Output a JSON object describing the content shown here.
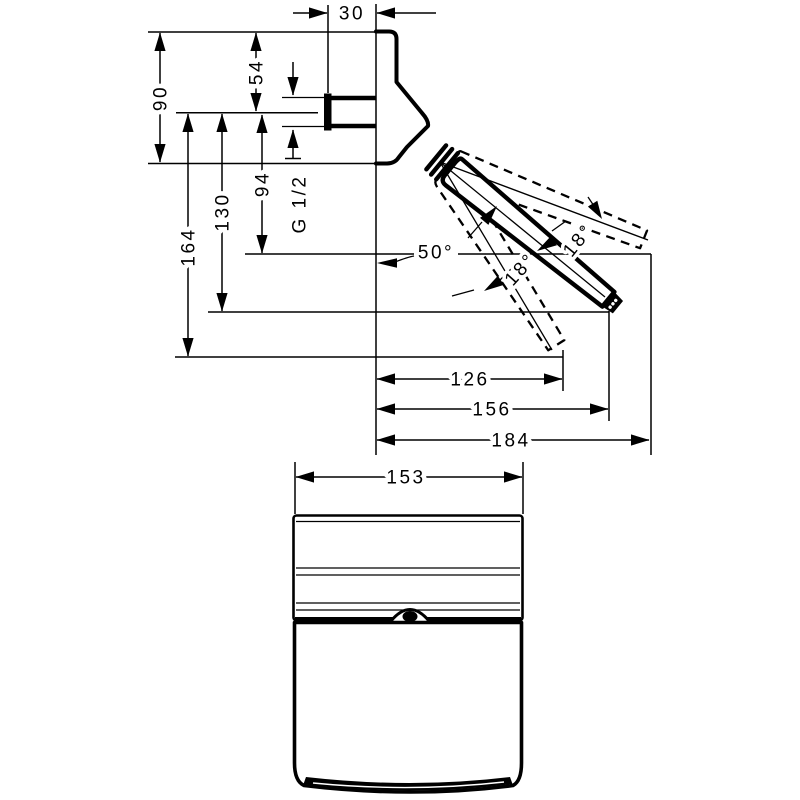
{
  "drawing": {
    "type": "technical-dimension-drawing",
    "units": "mm",
    "labels": {
      "depth_top": "30",
      "body_height": "90",
      "top_to_axis": "54",
      "axis_to_tip_up": "94",
      "axis_to_tip_mid": "130",
      "axis_to_tip_down": "164",
      "thread": "G 1/2",
      "angle_main": "50°",
      "angle_up": "18°",
      "angle_down": "18°",
      "reach_down": "126",
      "reach_mid": "156",
      "reach_up": "184",
      "front_width": "153"
    },
    "colors": {
      "ink": "#000000",
      "paper": "#ffffff"
    }
  }
}
